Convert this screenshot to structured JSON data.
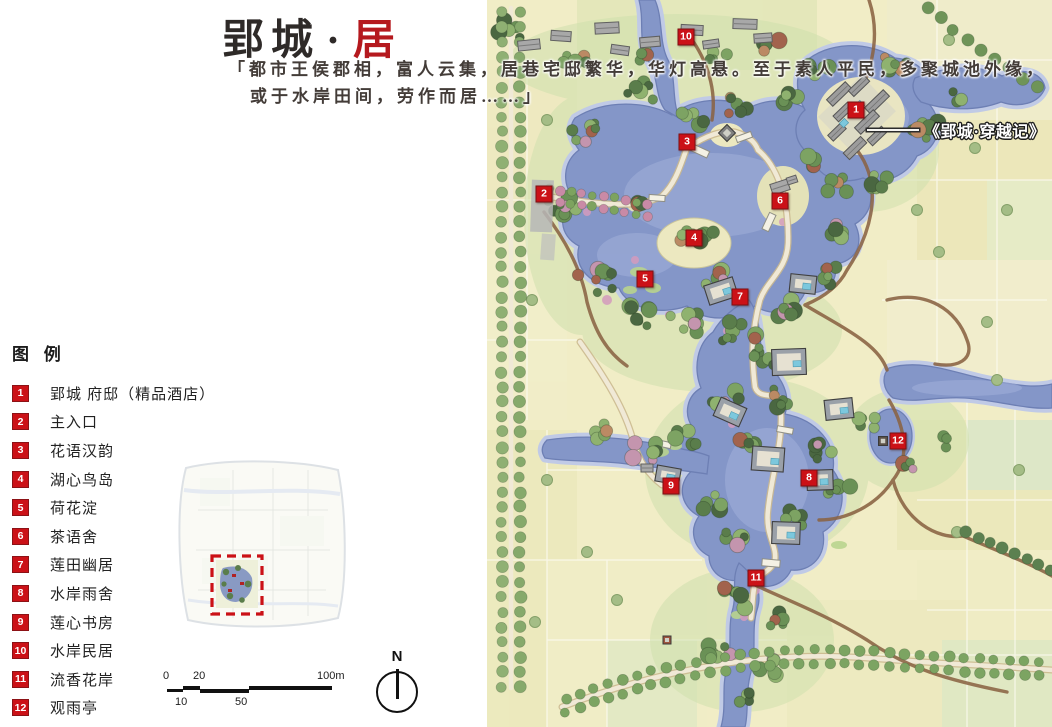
{
  "title": {
    "main": "郢城",
    "dot": "·",
    "accent": "居"
  },
  "quote": {
    "line1": "「都市王侯郡相，富人云集，居巷宅邸繁华，华灯高悬。至于素人平民，多聚城池外缘，",
    "line2": "或于水岸田间，劳作而居……」"
  },
  "legend": {
    "header": "图 例",
    "items": [
      {
        "num": "1",
        "label": "郢城 府邸（精品酒店）"
      },
      {
        "num": "2",
        "label": "主入口"
      },
      {
        "num": "3",
        "label": "花语汉韵"
      },
      {
        "num": "4",
        "label": "湖心鸟岛"
      },
      {
        "num": "5",
        "label": "荷花淀"
      },
      {
        "num": "6",
        "label": "茶语舍"
      },
      {
        "num": "7",
        "label": "莲田幽居"
      },
      {
        "num": "8",
        "label": "水岸雨舍"
      },
      {
        "num": "9",
        "label": "莲心书房"
      },
      {
        "num": "10",
        "label": "水岸民居"
      },
      {
        "num": "11",
        "label": "流香花岸"
      },
      {
        "num": "12",
        "label": "观雨亭"
      }
    ]
  },
  "map": {
    "annotation": "《郢城·穿越记》",
    "markers": [
      {
        "num": "1",
        "x": 369,
        "y": 110
      },
      {
        "num": "2",
        "x": 57,
        "y": 194
      },
      {
        "num": "3",
        "x": 200,
        "y": 142
      },
      {
        "num": "4",
        "x": 207,
        "y": 238
      },
      {
        "num": "5",
        "x": 158,
        "y": 279
      },
      {
        "num": "6",
        "x": 293,
        "y": 201
      },
      {
        "num": "7",
        "x": 253,
        "y": 297
      },
      {
        "num": "8",
        "x": 322,
        "y": 478
      },
      {
        "num": "9",
        "x": 184,
        "y": 486
      },
      {
        "num": "10",
        "x": 199,
        "y": 37
      },
      {
        "num": "11",
        "x": 269,
        "y": 578
      },
      {
        "num": "12",
        "x": 411,
        "y": 441
      }
    ]
  },
  "scale_bar": {
    "labels_top": [
      "0",
      "20",
      "100m"
    ],
    "labels_bottom": [
      "10",
      "50"
    ]
  },
  "compass": {
    "label": "N"
  },
  "colors": {
    "accent_red": "#b5191e",
    "marker_red": "#cb1117",
    "water": "#8496c8"
  }
}
